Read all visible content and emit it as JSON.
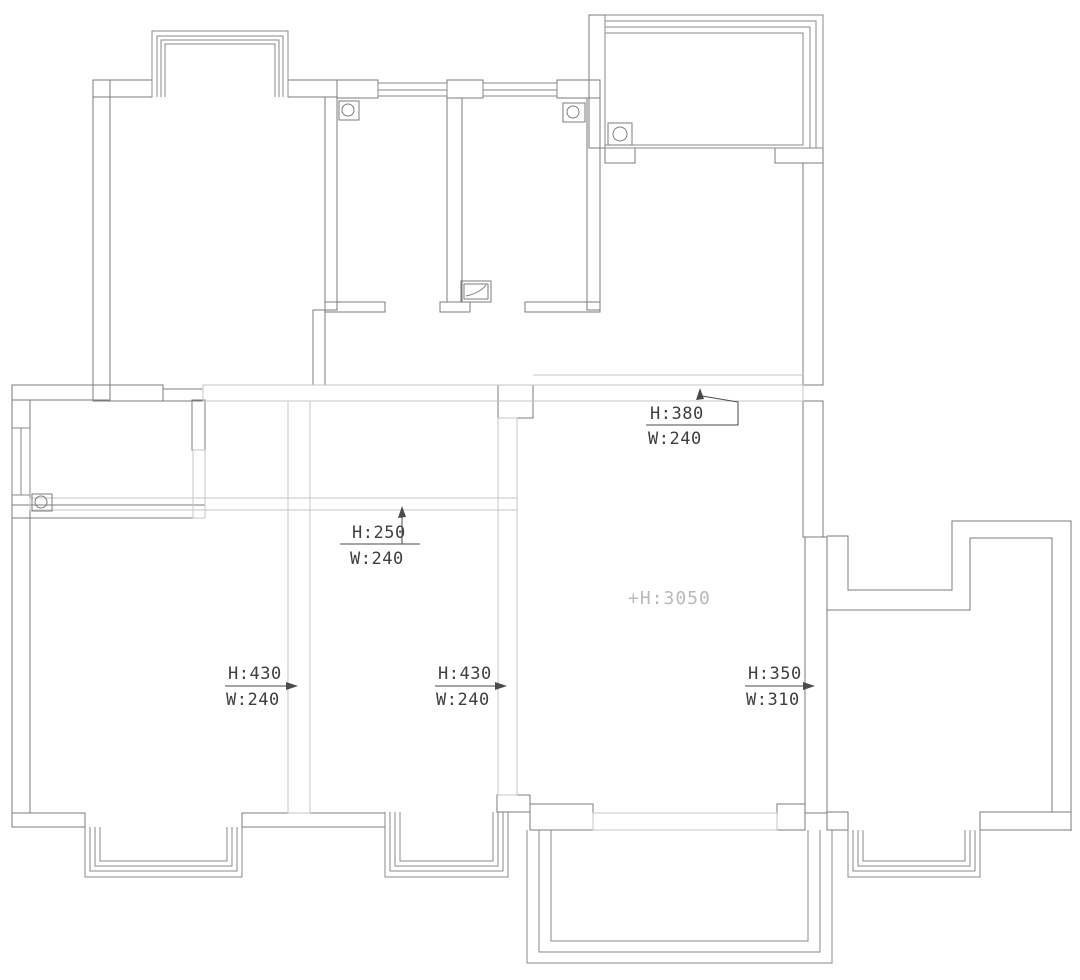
{
  "document": {
    "type": "floor-plan",
    "description": "Original structure apartment floor plan with beam and wall-opening dimension annotations"
  },
  "colors": {
    "wall_line": "#7b7b7b",
    "beam_line": "#c6c6c6",
    "annotation_text": "#3f3f3f",
    "ceiling_text": "#b9b9b9",
    "background": "#ffffff"
  },
  "ceiling_note": {
    "text": "+H:3050"
  },
  "annotations": [
    {
      "id": "beam-upper",
      "h": "H:380",
      "w": "W:240",
      "arrow": "up"
    },
    {
      "id": "beam-middle",
      "h": "H:250",
      "w": "W:240",
      "arrow": "up"
    },
    {
      "id": "opening-left",
      "h": "H:430",
      "w": "W:240",
      "arrow": "right"
    },
    {
      "id": "opening-center",
      "h": "H:430",
      "w": "W:240",
      "arrow": "right"
    },
    {
      "id": "opening-right",
      "h": "H:350",
      "w": "W:310",
      "arrow": "right"
    }
  ]
}
